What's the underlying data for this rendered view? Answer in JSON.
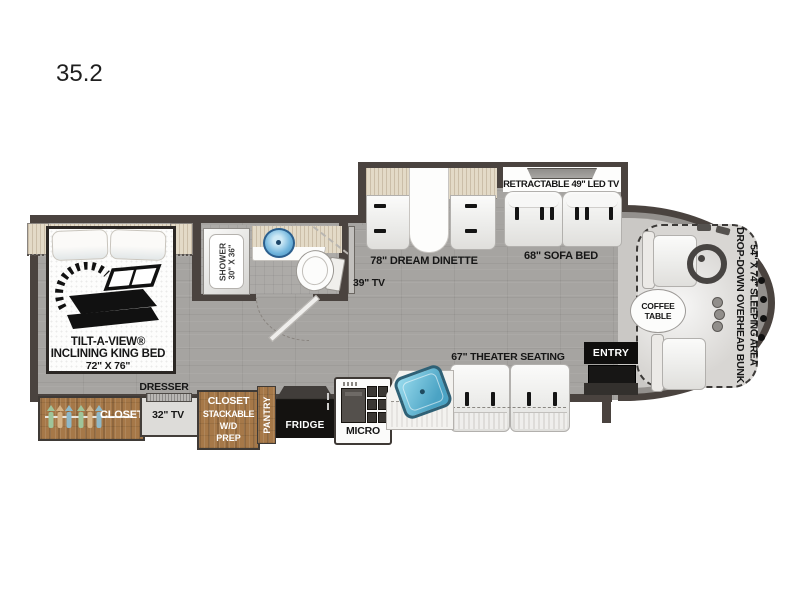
{
  "title": "35.2",
  "colors": {
    "wall": "#4a433f",
    "floor": "#a6a4a1",
    "bath_floor": "#adabA8",
    "cab_floor": "#cac8c5",
    "cab_band": "#93908d",
    "bunk_fill": "#d8d6d3",
    "wood": "#a67848",
    "beige": "#e3dac7",
    "sink_teal": "#4ba3c4",
    "bath_sink_blue": "#5fa8d8",
    "fridge_black": "#141210",
    "tv_gray": "#9a9895"
  },
  "bedroom": {
    "line1": "TILT-A-VIEW®",
    "line2": "INCLINING KING BED",
    "line3": "72\" X 76\""
  },
  "bath": {
    "shower1": "SHOWER",
    "shower2": "30\" X 36\""
  },
  "living": {
    "tv39": "39\" TV",
    "dinette": "78\" DREAM DINETTE",
    "retractable": "RETRACTABLE 49\" LED TV",
    "sofa": "68\" SOFA BED",
    "theater": "67\" THEATER SEATING"
  },
  "kitchen": {
    "micro": "MICRO",
    "fridge": "FRIDGE",
    "pantry": "PANTRY"
  },
  "storage": {
    "closet": "CLOSET",
    "dresser": "DRESSER",
    "tv32": "32\" TV",
    "wd1": "CLOSET",
    "wd2": "STACKABLE",
    "wd3": "W/D",
    "wd4": "PREP"
  },
  "cab": {
    "entry": "ENTRY",
    "coffee1": "COFFEE",
    "coffee2": "TABLE",
    "bunk1": "DROP-DOWN OVERHEAD BUNK",
    "bunk2": "54\" X 74\" SLEEPING AREA"
  },
  "icons": {
    "tilt_bed": "tilt-a-view-bed-icon",
    "steering": "steering-wheel-icon",
    "hangers": "clothes-hanger-icon",
    "range": "range-burners-icon",
    "sinks": "sink-basin-icon",
    "toilet": "toilet-icon"
  }
}
